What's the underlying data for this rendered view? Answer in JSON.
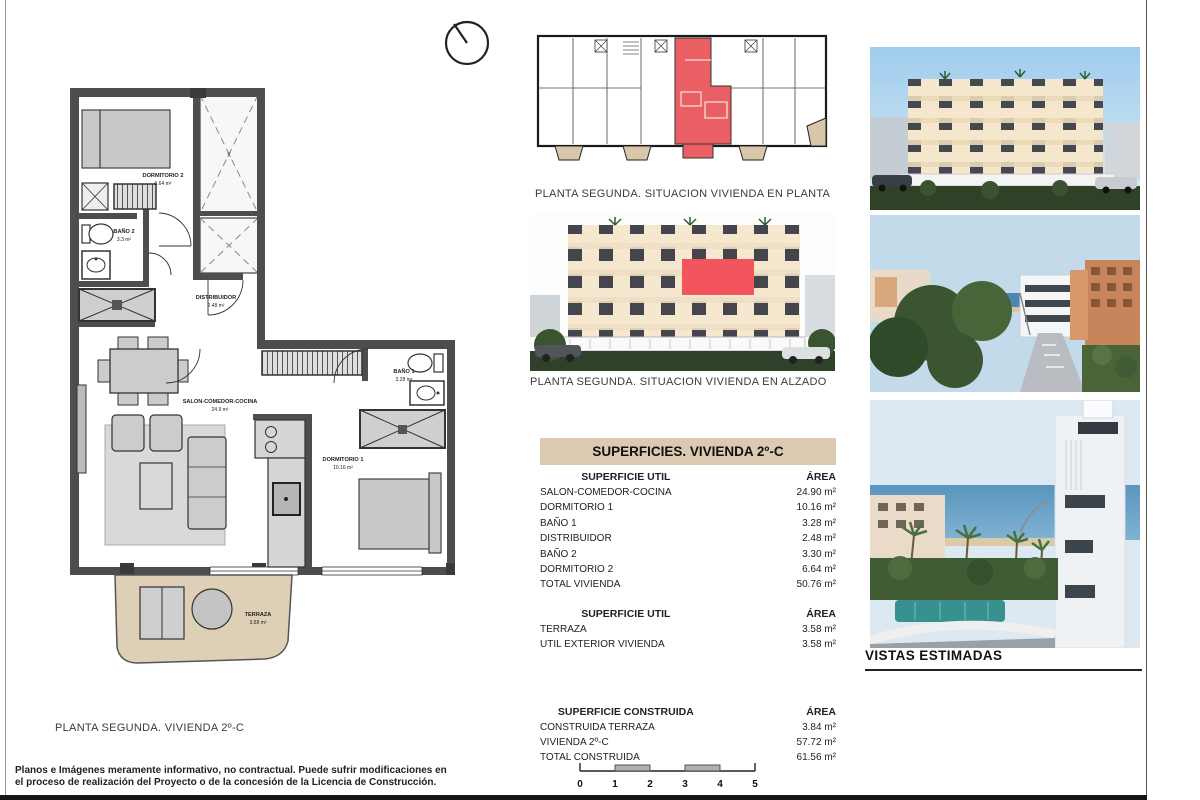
{
  "colors": {
    "accent_red": "#ea5f63",
    "header_tan": "#dcc9b2",
    "terrace_beige": "#ddd0b6",
    "wall_gray": "#4d4d4d"
  },
  "floor_plan": {
    "caption": "PLANTA SEGUNDA. VIVIENDA 2º-C",
    "rooms": {
      "dormitorio2": {
        "label": "DORMITORIO 2",
        "area": "6.64 m²"
      },
      "bano2": {
        "label": "BAÑO 2",
        "area": "3.3 m²"
      },
      "distribuidor": {
        "label": "DISTRIBUIDOR",
        "area": "2.48 m²"
      },
      "salon": {
        "label": "SALON-COMEDOR-COCINA",
        "area": "24.9 m²"
      },
      "bano1": {
        "label": "BAÑO 1",
        "area": "3.28 m²"
      },
      "dormitorio1": {
        "label": "DORMITORIO 1",
        "area": "10.16 m²"
      },
      "terraza": {
        "label": "TERRAZA",
        "area": "3.58 m²"
      }
    }
  },
  "situation_plan": {
    "caption": "PLANTA SEGUNDA. SITUACION VIVIENDA EN PLANTA"
  },
  "elevation_plan": {
    "caption": "PLANTA SEGUNDA. SITUACION VIVIENDA EN ALZADO"
  },
  "surfaces_table": {
    "title": "SUPERFICIES. VIVIENDA 2º-C",
    "sections": [
      {
        "header": "SUPERFICIE UTIL",
        "area_header": "ÁREA",
        "rows": [
          {
            "label": "SALON-COMEDOR-COCINA",
            "value": "24.90 m²"
          },
          {
            "label": "DORMITORIO 1",
            "value": "10.16 m²"
          },
          {
            "label": "BAÑO 1",
            "value": "3.28 m²"
          },
          {
            "label": "DISTRIBUIDOR",
            "value": "2.48 m²"
          },
          {
            "label": "BAÑO 2",
            "value": "3.30 m²"
          },
          {
            "label": "DORMITORIO 2",
            "value": "6.64 m²"
          },
          {
            "label": "TOTAL VIVIENDA",
            "value": "50.76 m²"
          }
        ]
      },
      {
        "header": "SUPERFICIE UTIL",
        "area_header": "ÁREA",
        "rows": [
          {
            "label": "TERRAZA",
            "value": "3.58 m²"
          },
          {
            "label": "UTIL EXTERIOR VIVIENDA",
            "value": "3.58 m²"
          }
        ]
      },
      {
        "header": "SUPERFICIE CONSTRUIDA",
        "area_header": "ÁREA",
        "rows": [
          {
            "label": "CONSTRUIDA TERRAZA",
            "value": "3.84 m²"
          },
          {
            "label": "VIVIENDA 2º-C",
            "value": "57.72 m²"
          },
          {
            "label": "TOTAL CONSTRUIDA",
            "value": "61.56 m²"
          }
        ]
      }
    ]
  },
  "vistas": {
    "caption": "VISTAS ESTIMADAS"
  },
  "footer": {
    "disclaimer_line1": "Planos e Imágenes meramente informativo, no contractual. Puede sufrir modificaciones en",
    "disclaimer_line2": "el proceso de realización del Proyecto o de la concesión de la Licencia de Construcción."
  },
  "scale_bar": {
    "labels": [
      "0",
      "1",
      "2",
      "3",
      "4",
      "5"
    ]
  }
}
